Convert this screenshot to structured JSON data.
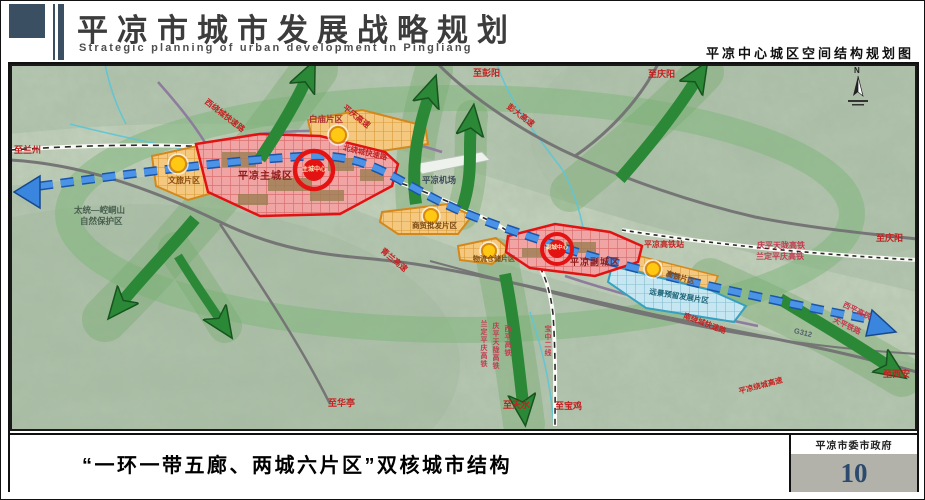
{
  "header": {
    "title": "平凉市城市发展战略规划",
    "subtitle": "Strategic planning of urban development in Pingliang",
    "map_name": "平凉中心城区空间结构规划图"
  },
  "footer": {
    "caption": "“一环一带五廊、两城六片区”双核城市结构",
    "agency": "平凉市委市政府",
    "page_number": "10"
  },
  "map": {
    "compass": "N",
    "labels": [
      "至兰州",
      "西绕城快速路",
      "平庆高速",
      "彭大高速",
      "至彭阳",
      "至庆阳",
      "白庙片区",
      "北绕城快速路",
      "平凉主城区",
      "主城中心",
      "文旅片区",
      "太统—崆峒山",
      "自然保护区",
      "平凉机场",
      "青兰高速",
      "商贸批发片区",
      "物流仓储片区",
      "平凉副城区",
      "副城中心",
      "平凉高铁站",
      "庆平天陇高铁",
      "兰定平庆高铁",
      "至庆阳",
      "高铁片区",
      "远景预留发展片区",
      "南绕城快速路",
      "G312",
      "西平高铁",
      "天平铁路",
      "平凉绕城高速",
      "至西安",
      "至华亭",
      "至天水",
      "至宝鸡",
      "兰定平庆高铁",
      "庆平天陇高铁",
      "西平高铁",
      "宝中二线"
    ]
  },
  "colors": {
    "header_slate": "#3b4f63",
    "main_city_fill": "#f0a4a4",
    "city_border_red": "#e21212",
    "district_orange": "#f4c87e",
    "reserved_blue": "#c6e7f1",
    "corridor_green": "#2b8836",
    "belt_blue": "#2f7fd4",
    "road_label_red": "#c32222",
    "page_number_blue": "#2c4a6e",
    "terrain_green": "#b7c9b2"
  }
}
